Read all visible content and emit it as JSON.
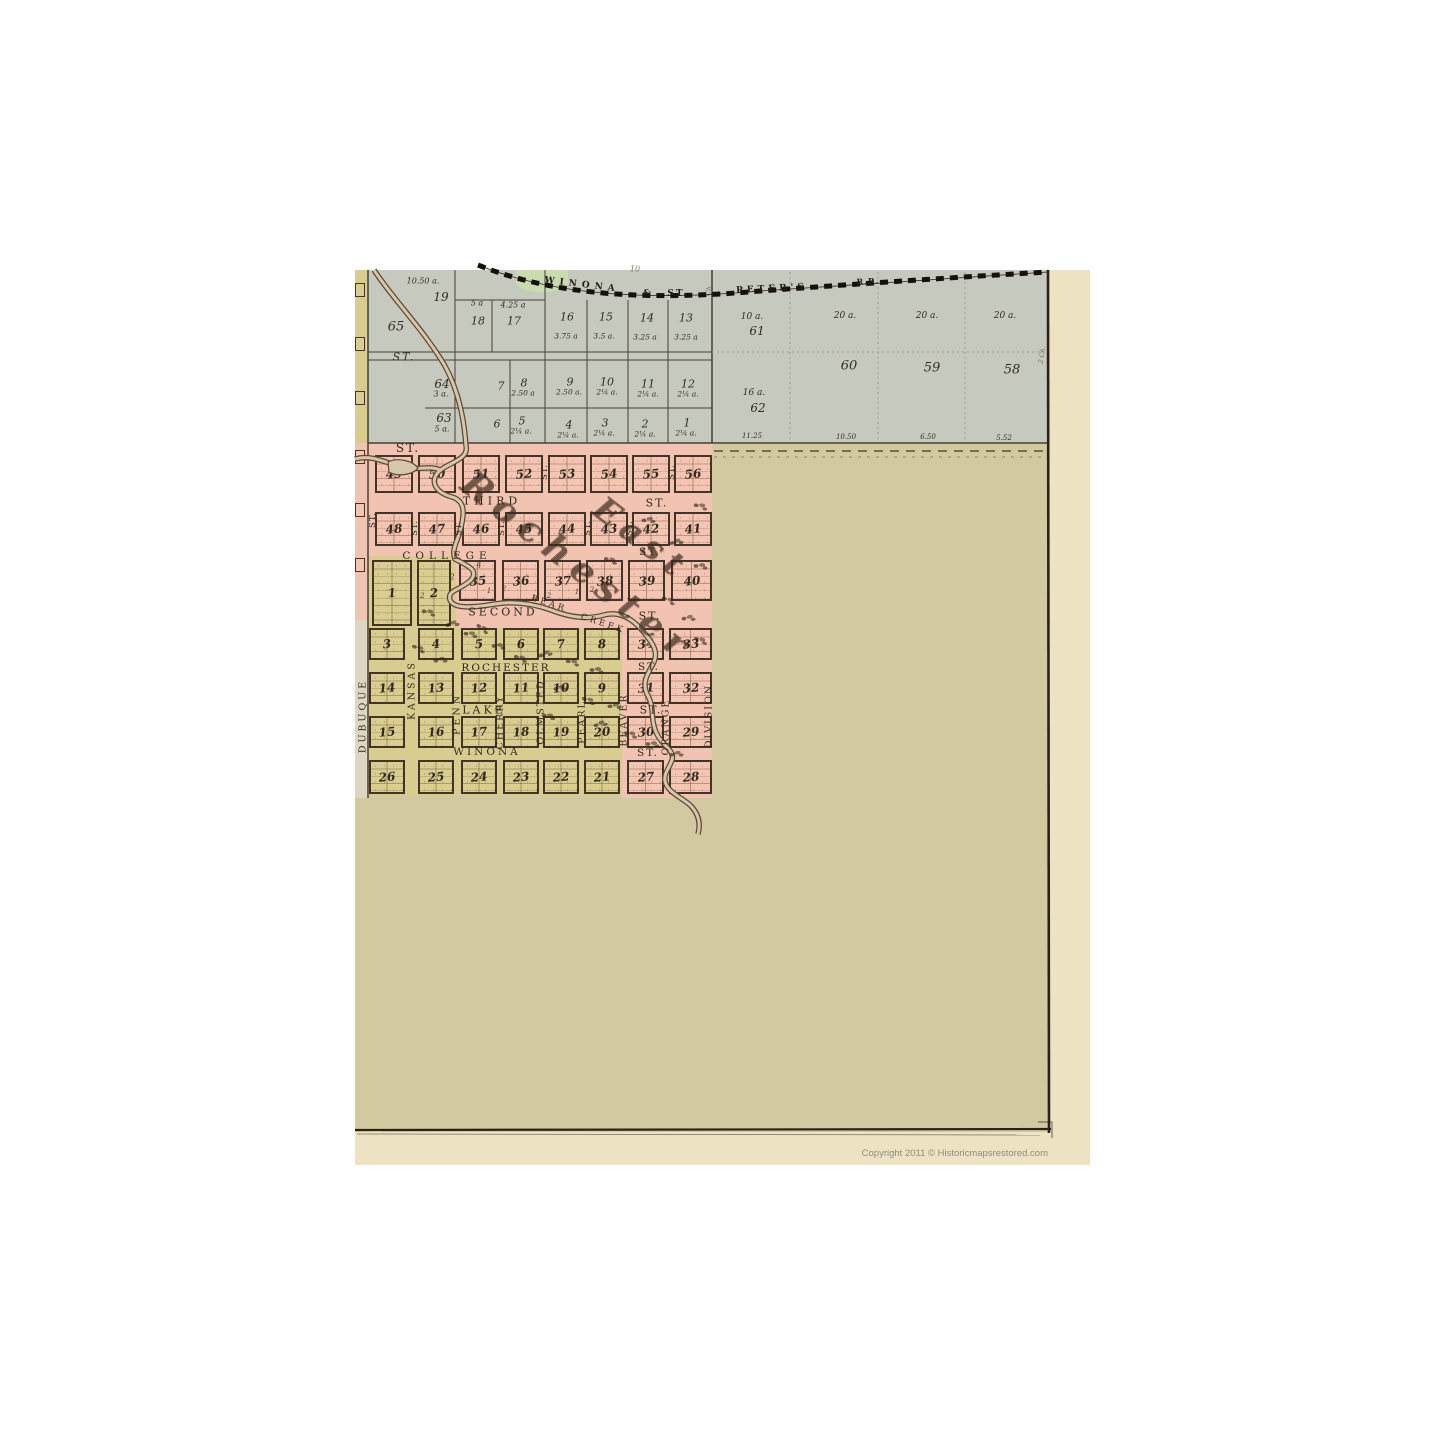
{
  "sheet": {
    "copyright": "Copyright 2011 ©  Historicmapsrestored.com"
  },
  "creek_name": "BEAR CREEK",
  "railroad_name": "WINONA & ST. PETER'S R.R.",
  "railroad_labels": [
    {
      "t": "WINONA",
      "x": 582,
      "y": 285,
      "s": 9,
      "r": 7,
      "ls": 5
    },
    {
      "t": "&",
      "x": 647,
      "y": 294,
      "s": 9
    },
    {
      "t": "ST.",
      "x": 678,
      "y": 294,
      "s": 9,
      "ls": 2
    },
    {
      "t": "PETER'S",
      "x": 772,
      "y": 289,
      "s": 9,
      "r": -3,
      "ls": 4
    },
    {
      "t": "R.R.",
      "x": 868,
      "y": 281,
      "s": 8,
      "r": -3,
      "ls": 1
    }
  ],
  "gray_lot_labels": [
    {
      "t": "10.50 a.",
      "x": 423,
      "y": 281,
      "s": 8
    },
    {
      "t": "19",
      "x": 441,
      "y": 297,
      "s": 12
    },
    {
      "t": "5 a",
      "x": 477,
      "y": 303,
      "s": 8
    },
    {
      "t": "4.25 a",
      "x": 513,
      "y": 305,
      "s": 8
    },
    {
      "t": "18",
      "x": 478,
      "y": 321,
      "s": 11
    },
    {
      "t": "17",
      "x": 514,
      "y": 321,
      "s": 11
    },
    {
      "t": "65",
      "x": 396,
      "y": 327,
      "s": 13
    },
    {
      "t": "16",
      "x": 567,
      "y": 317,
      "s": 11
    },
    {
      "t": "15",
      "x": 606,
      "y": 317,
      "s": 11
    },
    {
      "t": "14",
      "x": 647,
      "y": 318,
      "s": 11
    },
    {
      "t": "13",
      "x": 686,
      "y": 318,
      "s": 11
    },
    {
      "t": "3.75 a",
      "x": 566,
      "y": 336,
      "s": 7.5
    },
    {
      "t": "3.5 a.",
      "x": 604,
      "y": 336,
      "s": 7.5
    },
    {
      "t": "3.25 a",
      "x": 645,
      "y": 337,
      "s": 7.5
    },
    {
      "t": "3.25 a",
      "x": 686,
      "y": 337,
      "s": 7.5
    },
    {
      "t": "ST.",
      "x": 404,
      "y": 357,
      "s": 11,
      "ls": 2
    },
    {
      "t": "64",
      "x": 442,
      "y": 384,
      "s": 12
    },
    {
      "t": "3 a.",
      "x": 441,
      "y": 394,
      "s": 8
    },
    {
      "t": "7",
      "x": 501,
      "y": 386,
      "s": 11
    },
    {
      "t": "8",
      "x": 524,
      "y": 383,
      "s": 11
    },
    {
      "t": "2.50 a",
      "x": 523,
      "y": 393,
      "s": 7.5
    },
    {
      "t": "9",
      "x": 570,
      "y": 382,
      "s": 11
    },
    {
      "t": "2.50 a.",
      "x": 569,
      "y": 392,
      "s": 7.5
    },
    {
      "t": "10",
      "x": 607,
      "y": 382,
      "s": 11
    },
    {
      "t": "2¼ a.",
      "x": 607,
      "y": 392,
      "s": 7.5
    },
    {
      "t": "11",
      "x": 648,
      "y": 384,
      "s": 11
    },
    {
      "t": "2¼ a.",
      "x": 648,
      "y": 394,
      "s": 7.5
    },
    {
      "t": "12",
      "x": 688,
      "y": 384,
      "s": 11
    },
    {
      "t": "2¼ a.",
      "x": 688,
      "y": 394,
      "s": 7.5
    },
    {
      "t": "63",
      "x": 444,
      "y": 418,
      "s": 12
    },
    {
      "t": "5 a.",
      "x": 442,
      "y": 429,
      "s": 8
    },
    {
      "t": "6",
      "x": 497,
      "y": 424,
      "s": 11
    },
    {
      "t": "5",
      "x": 522,
      "y": 421,
      "s": 11
    },
    {
      "t": "2¼ a.",
      "x": 521,
      "y": 431,
      "s": 7.5
    },
    {
      "t": "4",
      "x": 569,
      "y": 425,
      "s": 11
    },
    {
      "t": "2¼ a.",
      "x": 568,
      "y": 435,
      "s": 7.5
    },
    {
      "t": "3",
      "x": 605,
      "y": 423,
      "s": 11
    },
    {
      "t": "2¼ a.",
      "x": 604,
      "y": 433,
      "s": 7.5
    },
    {
      "t": "2",
      "x": 645,
      "y": 424,
      "s": 11
    },
    {
      "t": "2¼ a.",
      "x": 645,
      "y": 434,
      "s": 7.5
    },
    {
      "t": "1",
      "x": 687,
      "y": 423,
      "s": 11
    },
    {
      "t": "2¼ a.",
      "x": 686,
      "y": 433,
      "s": 7.5
    },
    {
      "t": "10 a.",
      "x": 752,
      "y": 317,
      "s": 9
    },
    {
      "t": "61",
      "x": 757,
      "y": 331,
      "s": 12
    },
    {
      "t": "20 a.",
      "x": 845,
      "y": 316,
      "s": 9
    },
    {
      "t": "20 a.",
      "x": 927,
      "y": 316,
      "s": 9
    },
    {
      "t": "20 a.",
      "x": 1005,
      "y": 316,
      "s": 9
    },
    {
      "t": "60",
      "x": 849,
      "y": 366,
      "s": 13
    },
    {
      "t": "59",
      "x": 932,
      "y": 368,
      "s": 13
    },
    {
      "t": "58",
      "x": 1012,
      "y": 370,
      "s": 13
    },
    {
      "t": "16 a.",
      "x": 754,
      "y": 393,
      "s": 9
    },
    {
      "t": "62",
      "x": 758,
      "y": 408,
      "s": 12
    },
    {
      "t": "11.25",
      "x": 752,
      "y": 436,
      "s": 7
    },
    {
      "t": "10.50",
      "x": 846,
      "y": 437,
      "s": 7
    },
    {
      "t": "6.50",
      "x": 928,
      "y": 437,
      "s": 7
    },
    {
      "t": "5.52",
      "x": 1004,
      "y": 438,
      "s": 7
    }
  ],
  "street_labels": [
    {
      "t": "ST.",
      "x": 408,
      "y": 448,
      "s": 12,
      "ls": 2
    },
    {
      "t": "THIRD",
      "x": 492,
      "y": 501,
      "s": 11,
      "ls": 4
    },
    {
      "t": "ST.",
      "x": 657,
      "y": 503,
      "s": 11,
      "ls": 2
    },
    {
      "t": "COLLEGE",
      "x": 447,
      "y": 556,
      "s": 10.5,
      "ls": 5
    },
    {
      "t": "ST.",
      "x": 650,
      "y": 552,
      "s": 10.5,
      "ls": 2
    },
    {
      "t": "SECOND",
      "x": 503,
      "y": 612,
      "s": 11,
      "ls": 3
    },
    {
      "t": "ST.",
      "x": 650,
      "y": 616,
      "s": 11,
      "ls": 2
    },
    {
      "t": "BEAR",
      "x": 549,
      "y": 604,
      "s": 8.5,
      "r": 18,
      "ls": 3
    },
    {
      "t": "CREEK",
      "x": 603,
      "y": 624,
      "s": 8.5,
      "r": 18,
      "ls": 3
    },
    {
      "t": "ROCHESTER",
      "x": 506,
      "y": 668,
      "s": 10.5,
      "ls": 2
    },
    {
      "t": "ST.",
      "x": 649,
      "y": 667,
      "s": 10.5,
      "ls": 2
    },
    {
      "t": "LAKE",
      "x": 484,
      "y": 710,
      "s": 11,
      "ls": 3
    },
    {
      "t": "ST.",
      "x": 651,
      "y": 710,
      "s": 11,
      "ls": 2
    },
    {
      "t": "WINONA",
      "x": 487,
      "y": 752,
      "s": 10.5,
      "ls": 3
    },
    {
      "t": "ST.",
      "x": 648,
      "y": 753,
      "s": 10.5,
      "ls": 2
    }
  ],
  "vertical_street_labels": [
    {
      "t": "DUBUQUE",
      "x": 363,
      "y": 716,
      "s": 9.5,
      "r": -90,
      "ls": 3
    },
    {
      "t": "KANSAS",
      "x": 412,
      "y": 690,
      "s": 9.5,
      "r": -90,
      "ls": 3
    },
    {
      "t": "PENN",
      "x": 457,
      "y": 714,
      "s": 9.5,
      "r": -90,
      "ls": 3
    },
    {
      "t": "CHERRY",
      "x": 500,
      "y": 722,
      "s": 9.5,
      "r": -90,
      "ls": 2
    },
    {
      "t": "OLMSTED",
      "x": 541,
      "y": 712,
      "s": 9.5,
      "r": -90,
      "ls": 2
    },
    {
      "t": "PEARL",
      "x": 582,
      "y": 722,
      "s": 9.5,
      "r": -90,
      "ls": 2
    },
    {
      "t": "BEAVER",
      "x": 624,
      "y": 720,
      "s": 9.5,
      "r": -90,
      "ls": 2
    },
    {
      "t": "ORANGE",
      "x": 666,
      "y": 727,
      "s": 9.5,
      "r": -90,
      "ls": 2
    },
    {
      "t": "DIVISION",
      "x": 709,
      "y": 716,
      "s": 9.5,
      "r": -90,
      "ls": 2
    },
    {
      "t": "ST.",
      "x": 373,
      "y": 520,
      "s": 8.5,
      "r": -90,
      "ls": 1
    },
    {
      "t": "ST.",
      "x": 415,
      "y": 528,
      "s": 8.5,
      "r": -90,
      "ls": 1
    },
    {
      "t": "ST.",
      "x": 459,
      "y": 528,
      "s": 8.5,
      "r": -90,
      "ls": 1
    },
    {
      "t": "ST.",
      "x": 502,
      "y": 528,
      "s": 8.5,
      "r": -90,
      "ls": 1
    },
    {
      "t": "ST.",
      "x": 545,
      "y": 472,
      "s": 8.5,
      "r": -90,
      "ls": 1
    },
    {
      "t": "ST.",
      "x": 588,
      "y": 528,
      "s": 8.5,
      "r": -90,
      "ls": 1
    },
    {
      "t": "ST.",
      "x": 630,
      "y": 528,
      "s": 8.5,
      "r": -90,
      "ls": 1
    },
    {
      "t": "ST.",
      "x": 672,
      "y": 472,
      "s": 8.5,
      "r": -90,
      "ls": 1
    }
  ],
  "ornate_labels": [
    {
      "t": "East",
      "x": 642,
      "y": 538,
      "s": 33,
      "r": 38,
      "ls": 8
    },
    {
      "t": "Rochester",
      "x": 578,
      "y": 566,
      "s": 36,
      "r": 38,
      "ls": 9
    }
  ],
  "tiny_lot_labels": [
    {
      "t": "4",
      "x": 479,
      "y": 565,
      "s": 8
    },
    {
      "t": "2",
      "x": 452,
      "y": 577,
      "s": 8
    },
    {
      "t": "1",
      "x": 489,
      "y": 591,
      "s": 7
    },
    {
      "t": "2",
      "x": 504,
      "y": 589,
      "s": 7
    },
    {
      "t": "1",
      "x": 534,
      "y": 598,
      "s": 7
    },
    {
      "t": "2",
      "x": 549,
      "y": 596,
      "s": 7
    },
    {
      "t": "1",
      "x": 577,
      "y": 592,
      "s": 7
    },
    {
      "t": "2",
      "x": 592,
      "y": 590,
      "s": 7
    },
    {
      "t": "12",
      "x": 420,
      "y": 596,
      "s": 7
    }
  ],
  "misc_labels": [
    {
      "t": "10",
      "x": 635,
      "y": 269,
      "s": 8,
      "o": 0.7
    },
    {
      "t": "Ch.",
      "x": 709,
      "y": 290,
      "s": 7,
      "r": -75,
      "o": 0.7
    },
    {
      "t": "2 Ch.",
      "x": 1042,
      "y": 355,
      "s": 6.5,
      "r": -80,
      "o": 0.7
    }
  ],
  "blocks": [
    [
      375,
      455,
      38,
      38,
      "49",
      "p"
    ],
    [
      418,
      455,
      38,
      38,
      "50",
      "p"
    ],
    [
      462,
      455,
      38,
      38,
      "51",
      "p"
    ],
    [
      505,
      455,
      38,
      38,
      "52",
      "p"
    ],
    [
      548,
      455,
      38,
      38,
      "53",
      "p"
    ],
    [
      590,
      455,
      38,
      38,
      "54",
      "p"
    ],
    [
      632,
      455,
      38,
      38,
      "55",
      "p"
    ],
    [
      674,
      455,
      38,
      38,
      "56",
      "p"
    ],
    [
      375,
      512,
      38,
      34,
      "48",
      "p"
    ],
    [
      418,
      512,
      38,
      34,
      "47",
      "p"
    ],
    [
      462,
      512,
      38,
      34,
      "46",
      "p"
    ],
    [
      505,
      512,
      38,
      34,
      "45",
      "p"
    ],
    [
      548,
      512,
      38,
      34,
      "44",
      "p"
    ],
    [
      590,
      512,
      38,
      34,
      "43",
      "p"
    ],
    [
      632,
      512,
      38,
      34,
      "42",
      "p"
    ],
    [
      674,
      512,
      38,
      34,
      "41",
      "p"
    ],
    [
      459,
      560,
      37,
      41,
      "35",
      "p"
    ],
    [
      502,
      560,
      37,
      41,
      "36",
      "p"
    ],
    [
      544,
      560,
      37,
      41,
      "37",
      "p"
    ],
    [
      586,
      560,
      37,
      41,
      "38",
      "p"
    ],
    [
      628,
      560,
      37,
      41,
      "39",
      "p"
    ],
    [
      671,
      560,
      41,
      41,
      "40",
      "p"
    ],
    [
      372,
      560,
      40,
      66,
      "1",
      "y"
    ],
    [
      417,
      560,
      34,
      66,
      "2",
      "y"
    ],
    [
      369,
      628,
      36,
      32,
      "3",
      "y"
    ],
    [
      418,
      628,
      36,
      32,
      "4",
      "y"
    ],
    [
      461,
      628,
      36,
      32,
      "5",
      "y"
    ],
    [
      503,
      628,
      36,
      32,
      "6",
      "y"
    ],
    [
      543,
      628,
      36,
      32,
      "7",
      "y"
    ],
    [
      584,
      628,
      36,
      32,
      "8",
      "y"
    ],
    [
      369,
      672,
      36,
      32,
      "14",
      "y"
    ],
    [
      418,
      672,
      36,
      32,
      "13",
      "y"
    ],
    [
      461,
      672,
      36,
      32,
      "12",
      "y"
    ],
    [
      503,
      672,
      36,
      32,
      "11",
      "y"
    ],
    [
      543,
      672,
      36,
      32,
      "10",
      "y"
    ],
    [
      584,
      672,
      36,
      32,
      "9",
      "y"
    ],
    [
      369,
      716,
      36,
      32,
      "15",
      "y"
    ],
    [
      418,
      716,
      36,
      32,
      "16",
      "y"
    ],
    [
      461,
      716,
      36,
      32,
      "17",
      "y"
    ],
    [
      503,
      716,
      36,
      32,
      "18",
      "y"
    ],
    [
      543,
      716,
      36,
      32,
      "19",
      "y"
    ],
    [
      584,
      716,
      36,
      32,
      "20",
      "y"
    ],
    [
      369,
      760,
      36,
      34,
      "26",
      "y"
    ],
    [
      418,
      760,
      36,
      34,
      "25",
      "y"
    ],
    [
      461,
      760,
      36,
      34,
      "24",
      "y"
    ],
    [
      503,
      760,
      36,
      34,
      "23",
      "y"
    ],
    [
      543,
      760,
      36,
      34,
      "22",
      "y"
    ],
    [
      584,
      760,
      36,
      34,
      "21",
      "y"
    ],
    [
      627,
      628,
      37,
      32,
      "34",
      "p"
    ],
    [
      669,
      628,
      43,
      32,
      "33",
      "p"
    ],
    [
      627,
      672,
      37,
      32,
      "31",
      "p"
    ],
    [
      669,
      672,
      43,
      32,
      "32",
      "p"
    ],
    [
      627,
      716,
      37,
      32,
      "30",
      "p"
    ],
    [
      669,
      716,
      43,
      32,
      "29",
      "p"
    ],
    [
      627,
      760,
      37,
      34,
      "27",
      "p"
    ],
    [
      669,
      760,
      43,
      34,
      "28",
      "p"
    ],
    [
      355,
      283,
      10,
      14,
      "",
      "ys"
    ],
    [
      355,
      337,
      10,
      14,
      "",
      "ys"
    ],
    [
      355,
      391,
      10,
      14,
      "",
      "ys"
    ],
    [
      355,
      450,
      10,
      14,
      "",
      "ps"
    ],
    [
      355,
      503,
      10,
      14,
      "",
      "ps"
    ],
    [
      355,
      558,
      10,
      14,
      "",
      "ps"
    ]
  ],
  "trees": [
    [
      428,
      612,
      10
    ],
    [
      452,
      624,
      -15
    ],
    [
      470,
      634,
      5
    ],
    [
      418,
      648,
      20
    ],
    [
      440,
      660,
      -10
    ],
    [
      482,
      628,
      30
    ],
    [
      498,
      646,
      0
    ],
    [
      520,
      658,
      15
    ],
    [
      545,
      654,
      -20
    ],
    [
      572,
      662,
      10
    ],
    [
      596,
      670,
      0
    ],
    [
      560,
      688,
      -12
    ],
    [
      588,
      700,
      18
    ],
    [
      614,
      706,
      -5
    ],
    [
      548,
      716,
      8
    ],
    [
      600,
      724,
      -18
    ],
    [
      630,
      734,
      12
    ],
    [
      652,
      744,
      0
    ],
    [
      676,
      754,
      -10
    ],
    [
      700,
      640,
      15
    ],
    [
      688,
      618,
      -8
    ],
    [
      668,
      600,
      20
    ],
    [
      700,
      566,
      0
    ],
    [
      676,
      542,
      -15
    ],
    [
      700,
      506,
      10
    ],
    [
      648,
      520,
      -5
    ],
    [
      610,
      560,
      14
    ]
  ]
}
